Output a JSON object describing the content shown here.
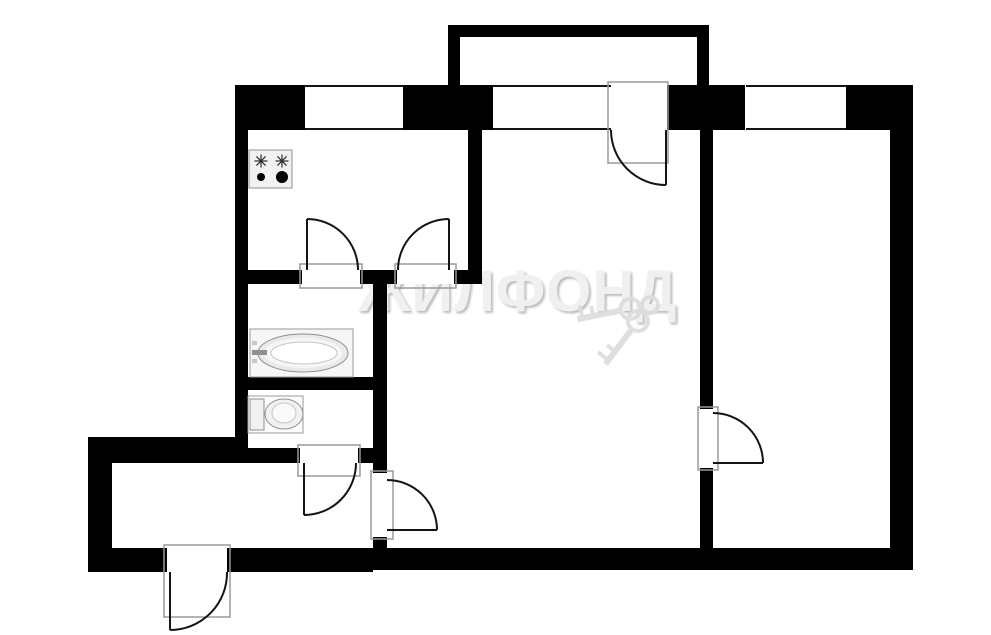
{
  "watermark": {
    "text": "ЖИЛФОНД"
  },
  "colors": {
    "wall": "#000000",
    "bg": "#ffffff",
    "line": "#141414",
    "frame": "#9a9a9a",
    "fixture_fill": "#f1f1f1",
    "fixture_stroke": "#8f8f8f",
    "fixture_mid": "#f6f6f6",
    "fixture_light": "#ffffff",
    "rim": "#c6c6c6",
    "burner": "#2b2b2b",
    "watermark_gray": "#dcdcdc"
  },
  "plan": {
    "width": 991,
    "height": 635,
    "walls": [
      [
        235,
        85,
        70,
        45
      ],
      [
        403,
        85,
        90,
        45
      ],
      [
        667,
        85,
        78,
        45
      ],
      [
        846,
        85,
        67,
        45
      ],
      [
        448,
        25,
        261,
        12
      ],
      [
        448,
        25,
        12,
        62
      ],
      [
        697,
        25,
        12,
        62
      ],
      [
        235,
        85,
        13,
        378
      ],
      [
        890,
        85,
        23,
        485
      ],
      [
        468,
        128,
        14,
        156
      ],
      [
        248,
        270,
        54,
        14
      ],
      [
        360,
        270,
        37,
        14
      ],
      [
        454,
        270,
        28,
        14
      ],
      [
        373,
        270,
        14,
        203
      ],
      [
        373,
        537,
        14,
        33
      ],
      [
        248,
        377,
        125,
        13
      ],
      [
        88,
        437,
        149,
        26
      ],
      [
        235,
        448,
        65,
        15
      ],
      [
        358,
        448,
        29,
        15
      ],
      [
        88,
        437,
        24,
        135
      ],
      [
        88,
        548,
        79,
        24
      ],
      [
        227,
        548,
        146,
        24
      ],
      [
        373,
        548,
        540,
        22
      ],
      [
        700,
        128,
        13,
        281
      ],
      [
        700,
        468,
        13,
        80
      ]
    ],
    "windows": [
      [
        305,
        85,
        98,
        45
      ],
      [
        493,
        85,
        118,
        45
      ],
      [
        746,
        85,
        100,
        45
      ]
    ],
    "doors": [
      {
        "name": "balcony-door",
        "opening": [
          611,
          85,
          55,
          45
        ],
        "frame": [
          608,
          82,
          60,
          81
        ],
        "leaf": [
          666,
          130,
          666,
          185
        ],
        "arc": "M 611 130 A 55 55 0 0 0 666 185"
      },
      {
        "name": "bathroom-door",
        "opening": [
          302,
          270,
          58,
          14
        ],
        "frame": [
          300,
          264,
          62,
          24
        ],
        "leaf": [
          307,
          270,
          307,
          219
        ],
        "arc": "M 307 219 A 51 51 0 0 1 358 270"
      },
      {
        "name": "kitchen-hall-door",
        "opening": [
          397,
          270,
          57,
          14
        ],
        "frame": [
          395,
          264,
          61,
          24
        ],
        "leaf": [
          449,
          270,
          449,
          219
        ],
        "arc": "M 449 219 A 51 51 0 0 0 398 270"
      },
      {
        "name": "wc-door",
        "opening": [
          300,
          448,
          58,
          15
        ],
        "frame": [
          298,
          445,
          62,
          31
        ],
        "leaf": [
          304,
          463,
          304,
          515
        ],
        "arc": "M 304 515 A 52 52 0 0 0 356 463"
      },
      {
        "name": "hall-room-door",
        "opening": [
          373,
          473,
          14,
          64
        ],
        "frame": [
          371,
          471,
          22,
          68
        ],
        "leaf": [
          387,
          530,
          437,
          530
        ],
        "arc": "M 387 480 A 50 50 0 0 1 437 530"
      },
      {
        "name": "bedroom-door",
        "opening": [
          700,
          409,
          13,
          59
        ],
        "frame": [
          698,
          407,
          20,
          63
        ],
        "leaf": [
          713,
          463,
          763,
          463
        ],
        "arc": "M 713 413 A 50 50 0 0 1 763 463"
      },
      {
        "name": "entrance-door",
        "opening": [
          167,
          548,
          60,
          24
        ],
        "frame": [
          164,
          545,
          66,
          72
        ],
        "leaf": [
          170,
          572,
          170,
          630
        ],
        "arc": "M 170 630 A 57 57 0 0 0 227 572"
      }
    ],
    "fixtures": {
      "stove": {
        "frame": [
          249,
          150,
          43,
          38
        ],
        "stars": [
          [
            261,
            161
          ],
          [
            282,
            161
          ]
        ],
        "dots": [
          [
            261,
            177,
            4
          ],
          [
            282,
            177,
            6
          ]
        ]
      },
      "bathtub": {
        "frame": [
          250,
          329,
          103,
          48
        ],
        "rims": [
          [
            303,
            353,
            45,
            19
          ],
          [
            303,
            353,
            39,
            15
          ],
          [
            304,
            353,
            33,
            11
          ]
        ],
        "faucet": [
          252,
          350,
          15,
          5
        ],
        "knobs": [
          [
            252,
            341,
            5,
            4
          ],
          [
            252,
            359,
            5,
            4
          ]
        ]
      },
      "toilet": {
        "frame": [
          248,
          396,
          55,
          37
        ],
        "tank": [
          250,
          399,
          14,
          31
        ],
        "bowl": [
          284,
          414,
          19,
          15
        ],
        "bowl_inner": [
          284,
          413,
          12,
          10
        ]
      }
    }
  }
}
